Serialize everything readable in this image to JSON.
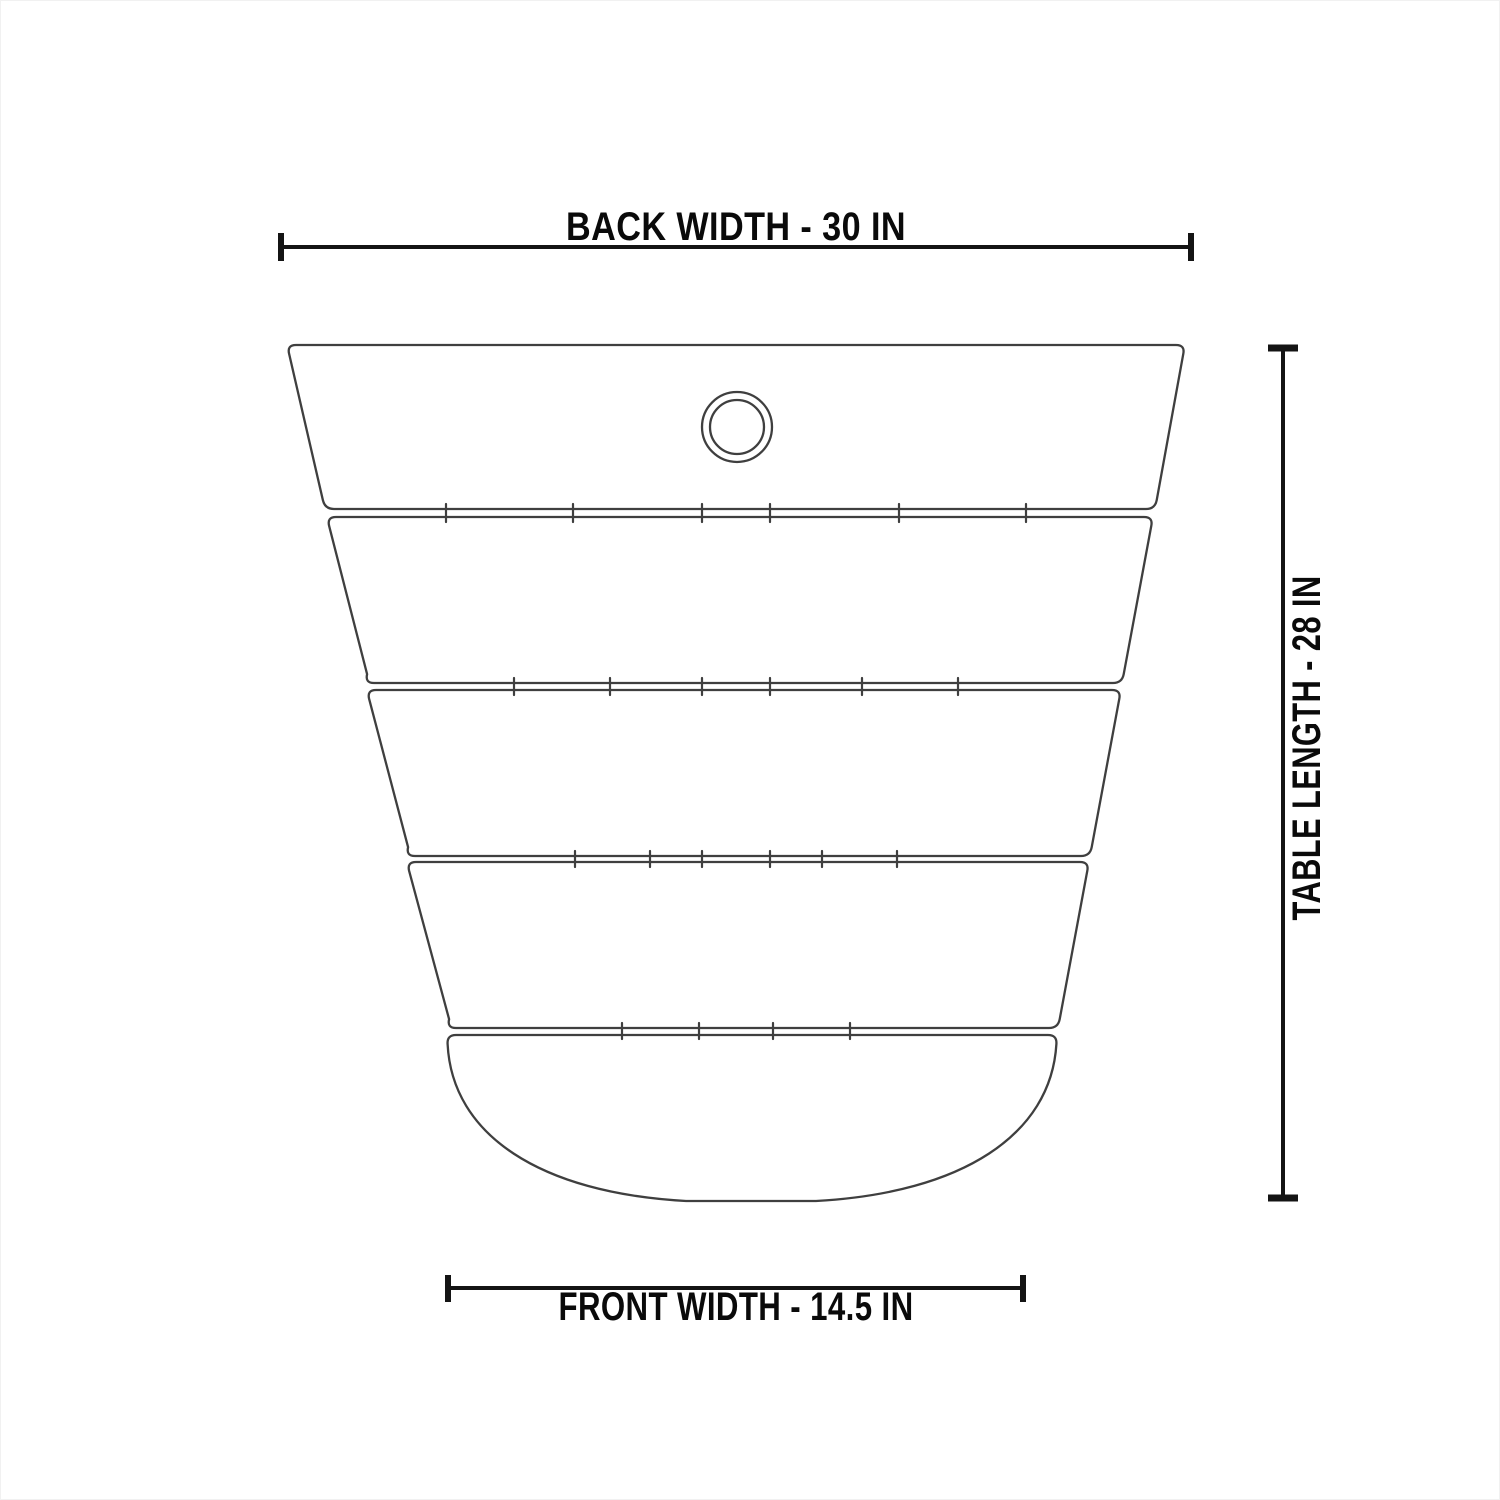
{
  "diagram": {
    "type": "dimension-drawing",
    "labels": {
      "back_width": "BACK WIDTH - 30 IN",
      "table_length": "TABLE LENGTH - 28 IN",
      "front_width": "FRONT WIDTH - 14.5 IN"
    },
    "measurements": {
      "back_width_in": 30,
      "table_length_in": 28,
      "front_width_in": 14.5
    },
    "features": {
      "slat_count": 5,
      "umbrella_hole_rings": 2,
      "bottom_edge": "rounded"
    },
    "colors": {
      "background": "#ffffff",
      "outline": "#3f3f3f",
      "dimension_line": "#141414",
      "label_text": "#0a0a0a"
    }
  }
}
